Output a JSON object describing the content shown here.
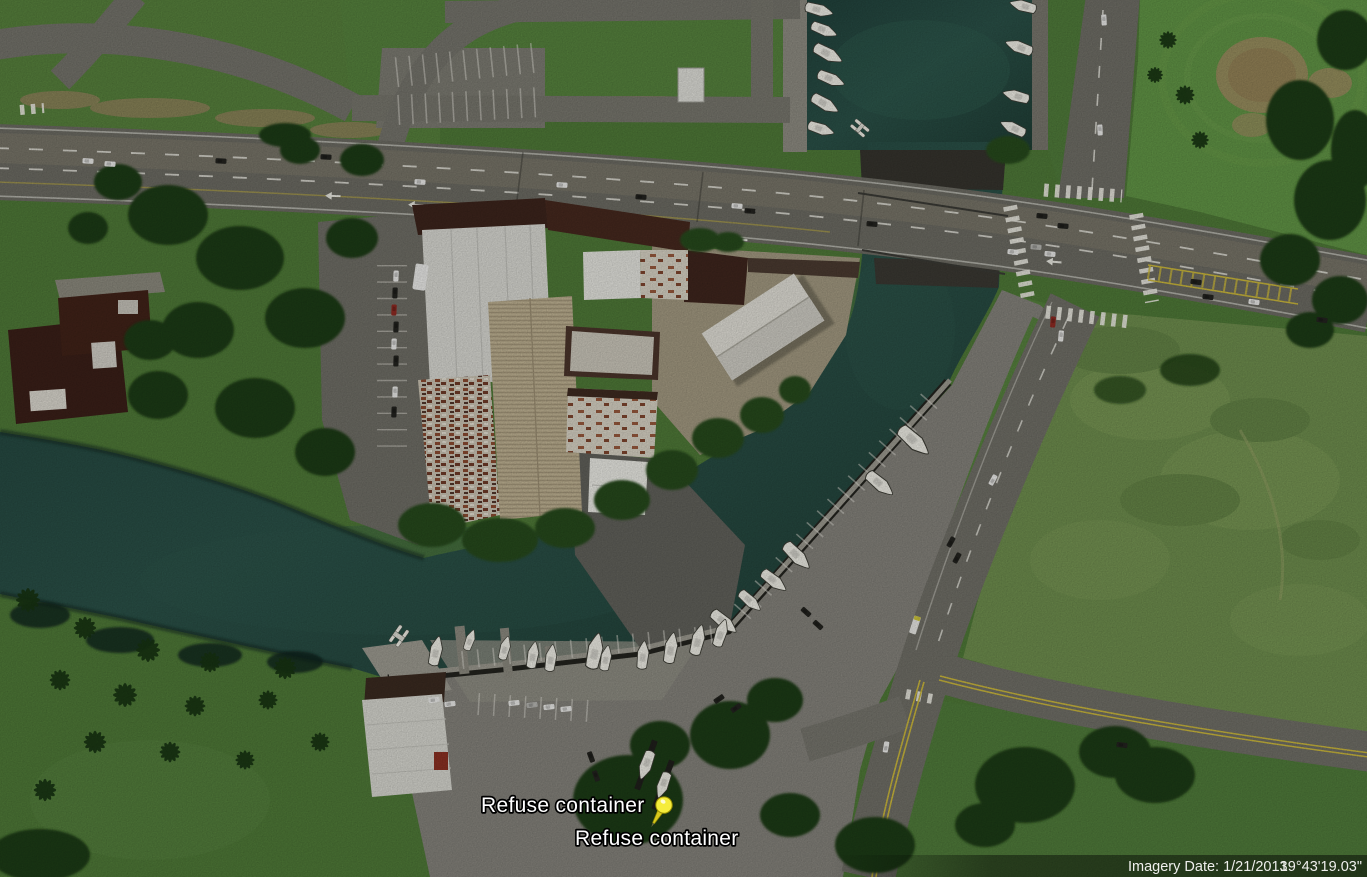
{
  "placemarks": {
    "pin_color": "#f5ec3b",
    "items": [
      {
        "label": "Refuse container"
      },
      {
        "label": "Refuse container"
      }
    ]
  },
  "status_bar": {
    "imagery_date": "Imagery Date: 1/21/2013",
    "coordinates": "19°43'19.03\""
  },
  "icons": [
    {
      "name": "pushpin-icon",
      "meaning": "placemark pin"
    }
  ],
  "colors": {
    "water": "#24463e",
    "water_light": "#2d564c",
    "grass_park": "#4e7837",
    "golf_green": "#5f9343",
    "field_scrub": "#6d8c4d",
    "road": "#6e6d65",
    "concrete": "#8b897f",
    "apron_tan": "#a0977f",
    "roof_white": "#d6d6d0",
    "roof_tan": "#b3a689",
    "roof_rust": "#8a4a30",
    "roof_brown": "#3c241c",
    "boat": "#ecebe3",
    "label_text": "#ffffff",
    "pin_yellow": "#f5ec3b",
    "status_text": "#efefed"
  }
}
